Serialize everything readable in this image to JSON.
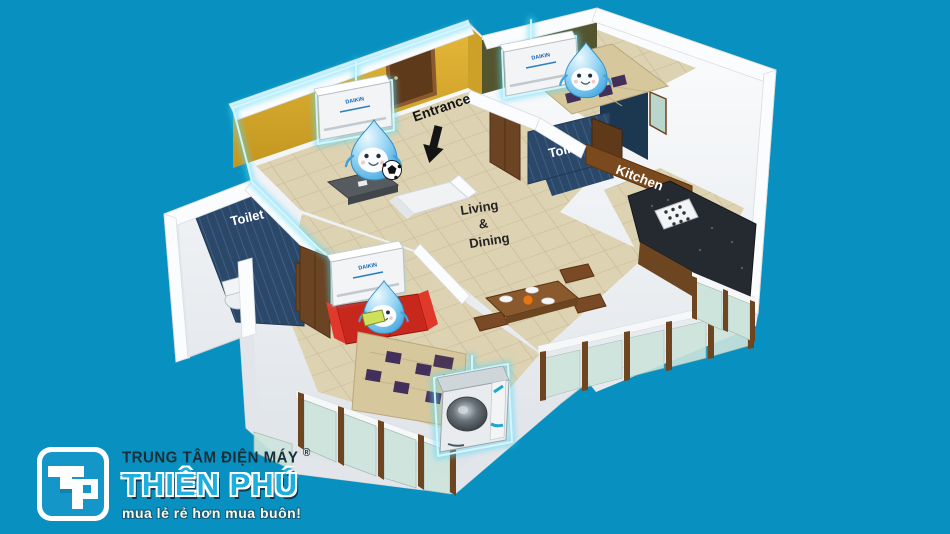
{
  "scene": {
    "background_color": "#0891c0"
  },
  "floorplan": {
    "labels": {
      "entrance": "Entrance",
      "living_dining": [
        "Living",
        "&",
        "Dining"
      ],
      "toilet_left": "Toilet",
      "toilet_right": "Toilet",
      "kitchen": "Kitchen"
    },
    "ac_brand": "DAIKIN",
    "colors": {
      "glow": "#8feaff",
      "wall_yellow": "#d9a92e",
      "toilet_blue": "#2c4a6e",
      "kitchen_wood": "#7a4a1e",
      "sofa_red": "#c8271c",
      "mascot_blue": "#45b0e6"
    }
  },
  "logo": {
    "monogram": "TP",
    "line1": "TRUNG TÂM ĐIỆN MÁY",
    "registered": "®",
    "name": "THIÊN PHÚ",
    "tagline": "mua lẻ rẻ hơn mua buôn!"
  }
}
